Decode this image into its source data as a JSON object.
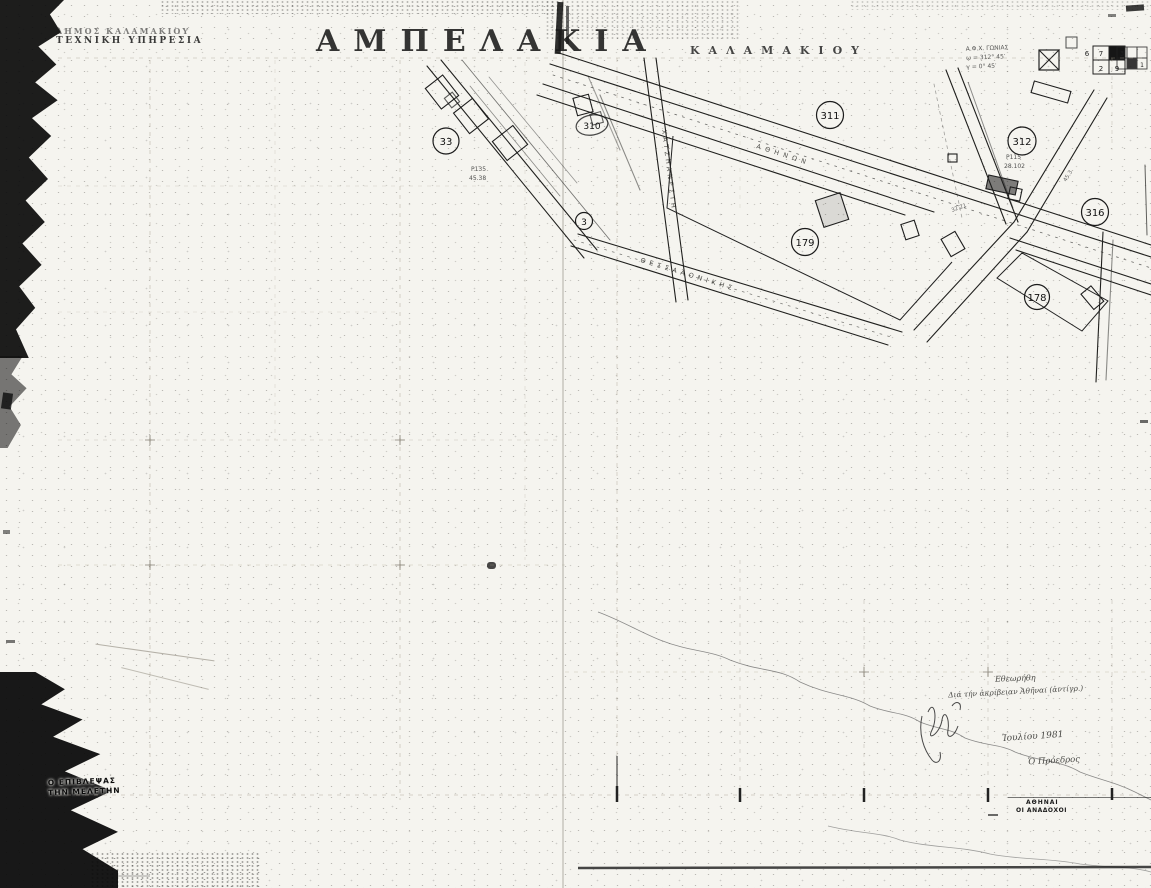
{
  "header": {
    "agency_line1": "ΔΗΜΟΣ ΚΑΛΑΜΑΚΙΟΥ",
    "agency_line2": "ΤΕΧΝΙΚΗ ΥΠΗΡΕΣΙΑ",
    "title": "ΑΜΠΕΛΑΚΙΑ",
    "subtitle": "ΚΑΛΑΜΑΚΙΟΥ",
    "survey_note": {
      "line1": "Α.Φ.Χ. ΓΩΝΙΑΣ",
      "line2": "ω = 312° 45′",
      "line3": "γ = 0° 45′"
    },
    "sheet_index": {
      "cells": [
        "6",
        "7",
        "2",
        "9"
      ],
      "corner_cells": [
        "3",
        "1"
      ]
    }
  },
  "map": {
    "circles": [
      {
        "label": "33"
      },
      {
        "label": "310"
      },
      {
        "label": "3"
      },
      {
        "label": "311"
      },
      {
        "label": "312"
      },
      {
        "label": "316"
      },
      {
        "label": "179"
      },
      {
        "label": "178"
      }
    ],
    "street_labels": [
      {
        "text": "ΑΘΗΝΩΝ"
      },
      {
        "text": "ΧΑΤΖΗΑΝΕΣΤΗ"
      },
      {
        "text": "ΘΕΣΣΑΛΟΝΙΚΗΣ"
      }
    ],
    "parcel_codes": [
      {
        "line1": "Ρ135",
        "line2": "45.38"
      },
      {
        "line1": "Ρ115",
        "line2": "28.102"
      }
    ],
    "dimension_labels": [
      {
        "text": "32.21"
      },
      {
        "text": "45.3"
      }
    ]
  },
  "annotations": {
    "stamp_left": {
      "line1": "Ο ΕΠΙΒΛΕΨΑΣ",
      "line2": "ΤΗΝ ΜΕΛΕΤΗΝ"
    },
    "handwritten": {
      "checked": "Εθεωρήθη",
      "accuracy": "Διά τήν ἀκρίβειαν  Ἀθῆναι (ἀντίγρ.)",
      "date": "Ἰουλίου 1981",
      "signatory": "Ὁ Πρόεδρος"
    },
    "printed_bottom_right": {
      "line1": "ΑΘΗΝΑΙ",
      "line2": "ΟΙ ΑΝΑΔΟΧΟΙ"
    }
  },
  "colors": {
    "paper": "#f5f4ef",
    "ink": "#1a1a1a",
    "pencil": "#a79f8f"
  }
}
